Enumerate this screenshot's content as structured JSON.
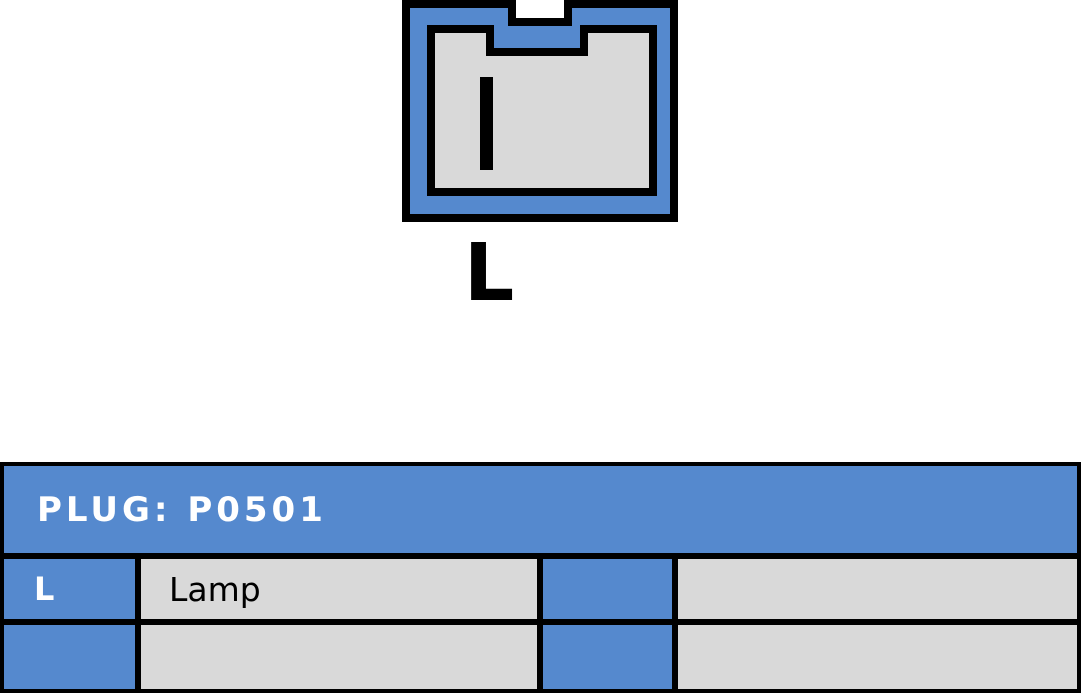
{
  "connector": {
    "pin_label": "L",
    "colors": {
      "shell_blue": "#5589CE",
      "cavity_gray": "#D9D9D9",
      "outline_black": "#000000"
    }
  },
  "plug_table": {
    "title": "PLUG: P0501",
    "colors": {
      "header_bg": "#5589CE",
      "header_text": "#FFFFFF",
      "pin_cell_bg": "#5589CE",
      "pin_cell_text": "#FFFFFF",
      "desc_cell_bg": "#D9D9D9",
      "desc_cell_text": "#000000",
      "border": "#000000"
    },
    "rows": [
      {
        "pin": "L",
        "description": "Lamp",
        "pin_right": "",
        "description_right": ""
      },
      {
        "pin": "",
        "description": "",
        "pin_right": "",
        "description_right": ""
      }
    ]
  }
}
